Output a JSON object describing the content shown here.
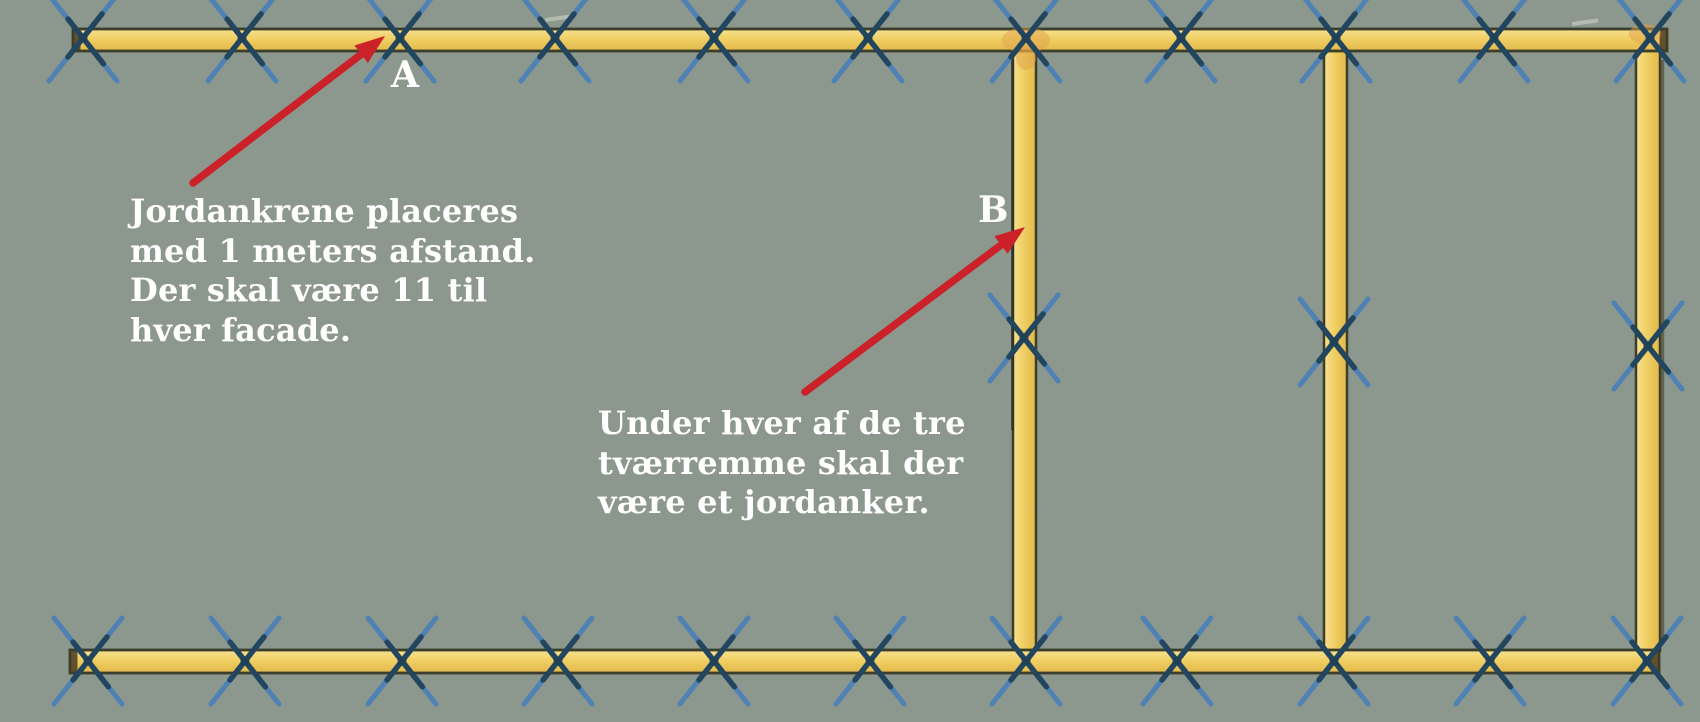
{
  "canvas": {
    "width": 1700,
    "height": 722,
    "background": "#8c978e"
  },
  "palette": {
    "beam_highlight": "#f7e191",
    "beam_fill": "#f0cf63",
    "beam_shade": "#e2b84a",
    "beam_outline": "#3a3e2b",
    "beam_cap": "#4a3b22",
    "anchor_light_blue": "#4e82b4",
    "anchor_dark_blue": "#1f4159",
    "arrow_red": "#cb2128",
    "text_white": "#ffffff",
    "junction_blotch": "#e2a24b",
    "scuff": "#dedfce"
  },
  "labels": {
    "a": "A",
    "b": "B"
  },
  "label_pos": {
    "a": {
      "x": 391,
      "y": 57
    },
    "b": {
      "x": 978,
      "y": 192
    }
  },
  "notes": {
    "a": {
      "x": 130,
      "y": 192,
      "lines": [
        "Jordankrene placeres",
        "med 1 meters afstand.",
        "Der skal være 11 til",
        "hver facade."
      ]
    },
    "b": {
      "x": 598,
      "y": 404,
      "lines": [
        "Under hver af de tre",
        "tværremme skal der",
        "være et jordanker."
      ]
    }
  },
  "frame": {
    "top_beam": {
      "x": 73,
      "y": 29,
      "w": 1594,
      "h": 22
    },
    "bottom_beam": {
      "x": 70,
      "y": 650,
      "w": 1589,
      "h": 23
    },
    "cross_beams": [
      {
        "x": 1013,
        "y": 50,
        "w": 23,
        "h": 601
      },
      {
        "x": 1324,
        "y": 50,
        "w": 23,
        "h": 601
      },
      {
        "x": 1636,
        "y": 47,
        "w": 24,
        "h": 604
      }
    ]
  },
  "anchors": {
    "top": {
      "y": 38,
      "xs": [
        83,
        242,
        400,
        555,
        714,
        868,
        1026,
        1181,
        1336,
        1494,
        1650
      ]
    },
    "bottom": {
      "y": 661,
      "xs": [
        88,
        245,
        402,
        558,
        714,
        870,
        1026,
        1177,
        1334,
        1490,
        1647
      ]
    },
    "mid": [
      {
        "x": 1024,
        "y": 338
      },
      {
        "x": 1334,
        "y": 342
      },
      {
        "x": 1648,
        "y": 346
      }
    ]
  },
  "arrows": [
    {
      "x1": 193,
      "y1": 183,
      "x2": 385,
      "y2": 36
    },
    {
      "x1": 805,
      "y1": 392,
      "x2": 1025,
      "y2": 227
    }
  ],
  "blotches": [
    {
      "x": 1026,
      "y": 40,
      "rx": 24,
      "ry": 13
    },
    {
      "x": 1026,
      "y": 58,
      "rx": 10,
      "ry": 12
    },
    {
      "x": 1645,
      "y": 34,
      "rx": 16,
      "ry": 10
    }
  ],
  "scuffs": [
    {
      "x": 545,
      "y": 18,
      "w": 26,
      "h": 4
    },
    {
      "x": 1572,
      "y": 22,
      "w": 26,
      "h": 4
    }
  ]
}
